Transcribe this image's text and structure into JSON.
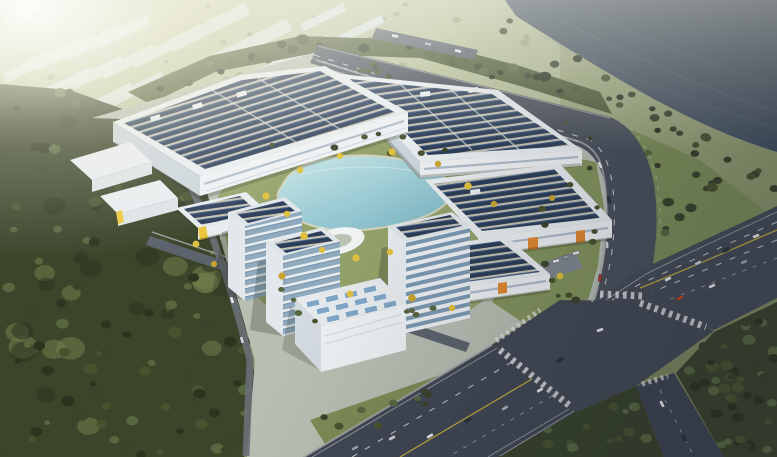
{
  "meta": {
    "title": "Aerial rendering of a solar-powered factory campus",
    "description": "Bird's-eye architectural rendering: industrial campus with large factory halls covered in rooftop solar arrays, a central landscaped lake with yellow gingko trees, glass office towers, an exhibition hall with skylight roof, surrounding forest parkland, a dark river along the top right and a multi-lane highway interchange on the right."
  },
  "scene": {
    "landmarks": [
      "large factory halls with rooftop solar arrays",
      "central landscaped lake with pavilion",
      "glass office towers",
      "exhibition hall with skylight grid roof",
      "distant warehouse district in haze",
      "river waterfront",
      "multi-lane highway with intersection and crosswalks",
      "dense forest parkland"
    ]
  },
  "colors": {
    "solar_panel": "#2c3e58",
    "solar_panel_hi": "#4a6694",
    "solar_gap": "#c8c3b2",
    "roof_white": "#e9edf0",
    "facade_light": "#eef1f3",
    "facade_shade": "#ccd5db",
    "glass_blue": "#8fa9bf",
    "band_glass": "#7c99b0",
    "accent_orange": "#e2882e",
    "accent_yellow": "#eec63e",
    "asphalt": "#454b56",
    "asphalt_light": "#565d68",
    "lane_white": "#e8eaea",
    "lane_yellow": "#d2bc3a",
    "river_light": "#516070",
    "river_deep": "#2b3642",
    "lake_light": "#c9e7ea",
    "lake_deep": "#7fbccb",
    "forest_deep": "#2c3420",
    "forest_dark": "#39432a",
    "forest_mid": "#47532f",
    "forest_light": "#586740",
    "grass_dk": "#77824e",
    "grass": "#8b9760",
    "grass_lt": "#9da560",
    "campus_green": "#93a26a",
    "ground": "#b8bfb2",
    "tree_yellow": "#e0c13d",
    "tree_yellow2": "#c9a52f",
    "far_tree": "#7b8a61",
    "far_tree2": "#6c7b54",
    "haze": "#f3f4ea"
  }
}
